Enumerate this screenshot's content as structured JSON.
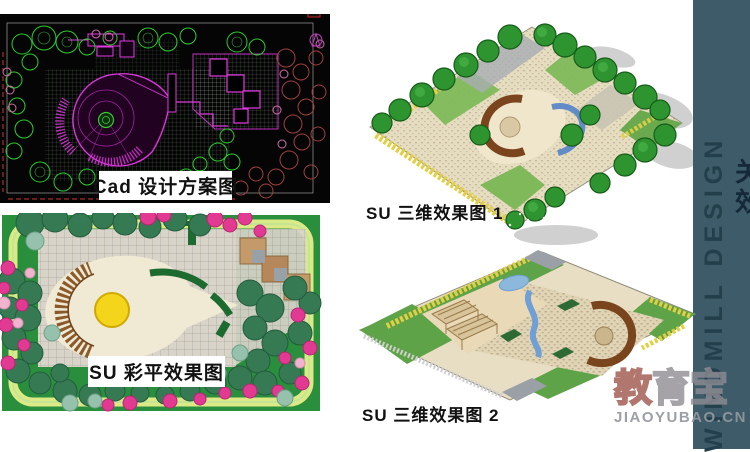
{
  "slide": {
    "panels": {
      "cad": {
        "caption": "Cad 设计方案图"
      },
      "color_plan": {
        "caption": "SU 彩平效果图"
      },
      "render_1": {
        "caption": "SU 三维效果图 1"
      },
      "render_2": {
        "caption": "SU 三维效果图 2"
      }
    },
    "sidebar": {
      "vertical_text": "WINDMILL DESIGN",
      "edge_char_1": "关",
      "edge_char_2": "效",
      "bg_color": "#3d5b69",
      "text_color": "#243f4c"
    },
    "watermark": {
      "brand_char_1": "教",
      "brand_rest": "育宝",
      "domain": "JIAOYUBAO.CN",
      "brand_red": "#9e5448",
      "brand_gray": "#8e8c92"
    }
  }
}
